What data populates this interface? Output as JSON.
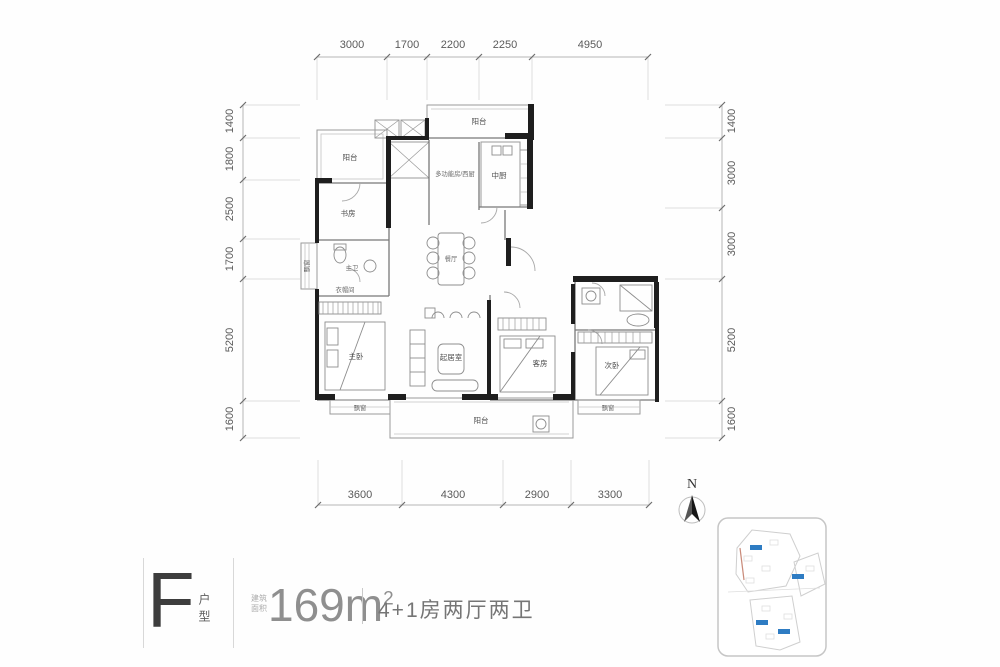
{
  "colors": {
    "background": "#fefefe",
    "wall": "#1e1e1e",
    "thin_line": "#9a9a9a",
    "dimension_text": "#5a5a5a",
    "marker_blue": "#2e7cc3",
    "title_gray": "#8f8f8f"
  },
  "dims": {
    "top": [
      "3000",
      "1700",
      "2200",
      "2250",
      "4950"
    ],
    "bottom": [
      "3600",
      "4300",
      "2900",
      "3300"
    ],
    "left": [
      "1400",
      "1800",
      "2500",
      "1700",
      "5200",
      "1600"
    ],
    "right": [
      "1400",
      "3000",
      "3000",
      "5200",
      "1600"
    ]
  },
  "rooms": {
    "balcony_top_left": "阳台",
    "study": "书房",
    "multi_function": "多功能房/西厨",
    "kitchen": "中厨",
    "balcony_top_right": "阳台",
    "dining": "餐厅",
    "master_bath": "主卫",
    "closet": "衣帽间",
    "bay_left": "飘窗",
    "master_bedroom": "主卧",
    "bay_master": "飘窗",
    "living": "起居室",
    "guest_room": "客房",
    "second_bedroom": "次卧",
    "bay_second": "飘窗",
    "balcony_bottom": "阳台"
  },
  "compass": {
    "north": "N"
  },
  "title": {
    "letter": "F",
    "suffix": "户型",
    "area_label": "建筑面积",
    "area": "169m",
    "area_sup": "2",
    "desc": "4+1房两厅两卫"
  }
}
